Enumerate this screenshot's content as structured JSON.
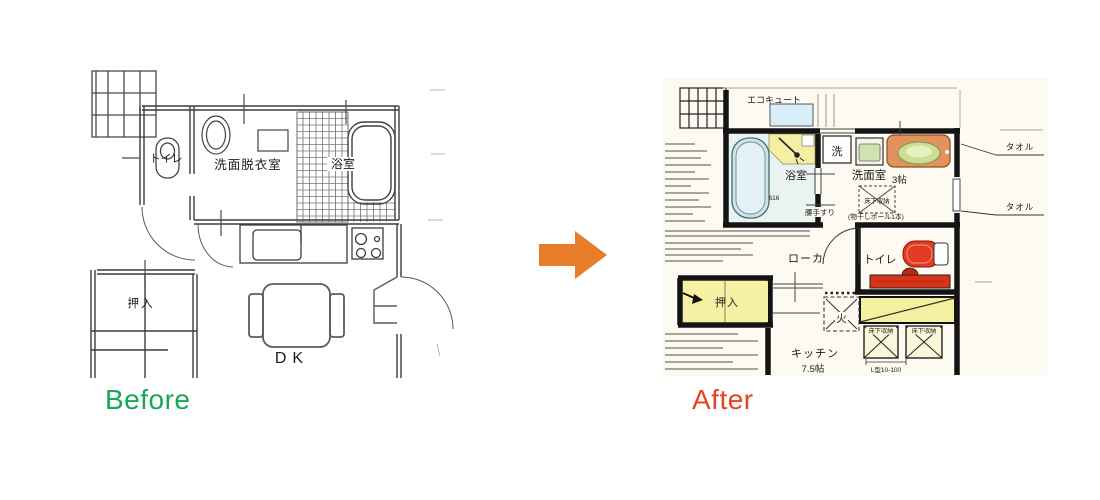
{
  "before": {
    "caption": "Before",
    "caption_color": "#17a75b",
    "plan": {
      "toilet_label": "トイレ",
      "washroom_label": "洗面脱衣室",
      "bath_label": "浴室",
      "closet_label": "押入",
      "dk_label": "DK"
    }
  },
  "arrow": {
    "color": "#e87e2b",
    "direction": "right"
  },
  "after": {
    "caption": "After",
    "caption_color": "#e8431f",
    "plan": {
      "ecocute_label": "エコキュート",
      "bath_label": "浴室",
      "bath_dim": "616",
      "handrail_label": "腰手すり",
      "washer_label": "洗",
      "washroom_label": "洗面室",
      "washroom_size": "3帖",
      "underfloor_label": "床下収納",
      "pole_note": "(物干しポール1本)",
      "towel_label_top": "タオル",
      "towel_label_bottom": "タオル",
      "corridor_label": "ローカ",
      "toilet_label": "トイレ",
      "closet_label": "押入",
      "fire_label": "火",
      "kitchen_label": "キッチン",
      "kitchen_size": "7.5帖",
      "underfloor_label_2": "床下収納",
      "underfloor_label_3": "床下収納",
      "dim_note": "L型10-100"
    }
  }
}
